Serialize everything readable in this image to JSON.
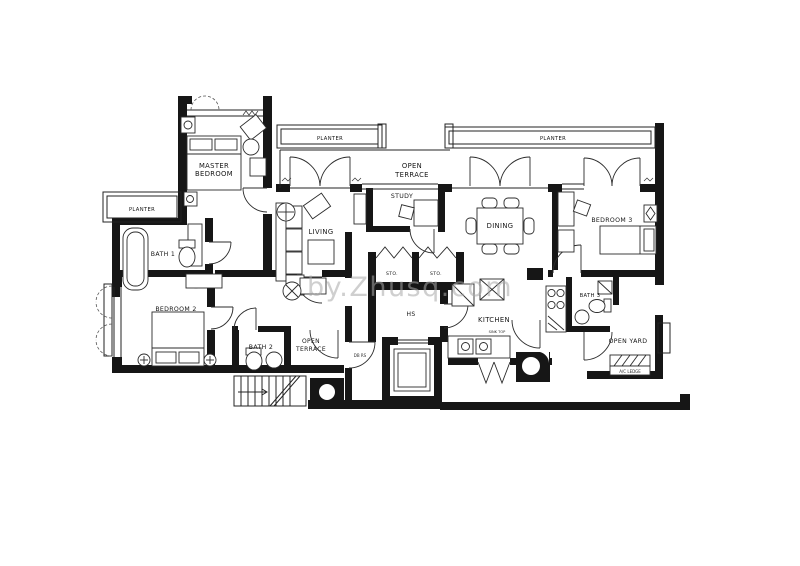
{
  "title": "apartment-floor-plan",
  "colors": {
    "wall": "#161616",
    "line": "#232323",
    "watermark": "#a9a9a9",
    "background": "#ffffff"
  },
  "watermark": "by.Zhusq.com",
  "labels": {
    "master1": "MASTER",
    "master2": "BEDROOM",
    "planter_left": "PLANTER",
    "planter_top_left": "PLANTER",
    "planter_top_right": "PLANTER",
    "terrace1": "OPEN",
    "terrace2": "TERRACE",
    "terrace_b1": "OPEN",
    "terrace_b2": "TERRACE",
    "bath1": "BATH 1",
    "bath2": "BATH 2",
    "bath3": "BATH 3",
    "bedroom2": "BEDROOM 2",
    "bedroom3": "BEDROOM 3",
    "living": "LIVING",
    "dining": "DINING",
    "study": "STUDY",
    "sto": "STO.",
    "hs": "HS",
    "kitchen": "KITCHEN",
    "kitchen_note": "SINK TOP",
    "open_yard": "OPEN YARD",
    "ac_ledge": "A/C LEDGE",
    "riser": "DB RS"
  }
}
